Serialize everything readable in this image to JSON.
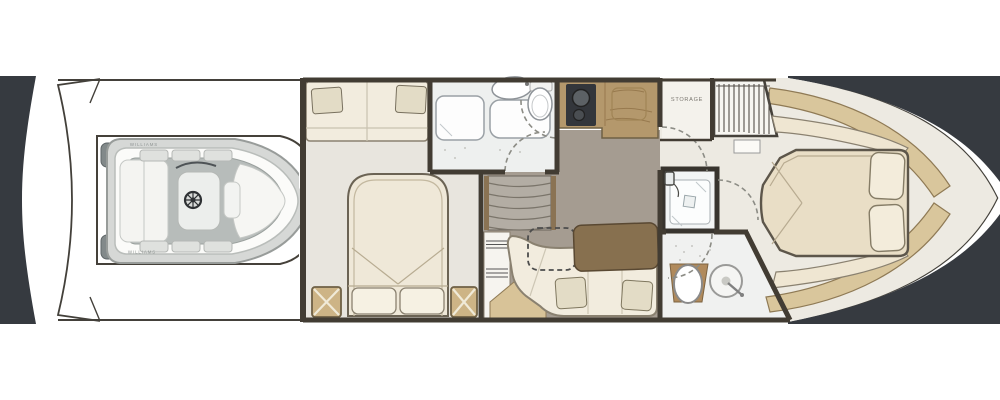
{
  "diagram": {
    "kind": "yacht-lower-deck-floor-plan",
    "orientation": "bow-right-stern-left"
  },
  "labels": {
    "storage": "STORAGE",
    "tender_brand_top": "WILLIAMS",
    "tender_brand_bottom": "WILLIAMS"
  },
  "colors": {
    "canvas": "#ffffff",
    "water_dark": "#363a40",
    "wall": "#423c33",
    "salon_floor_taupe": "#a59c91",
    "cabin_floor_light": "#e8e5de",
    "bathroom_floor": "#eef0ef",
    "cream_upholstery": "#f2ecde",
    "pillow_beige": "#e3dcc6",
    "galley_counter_wood": "#b4986c",
    "table_wood": "#87704f",
    "gold_trim": "#d9c69c",
    "nightstand_gold": "#cdb486",
    "stove_black": "#33363b",
    "tender_gray": "#d6d8d6"
  }
}
